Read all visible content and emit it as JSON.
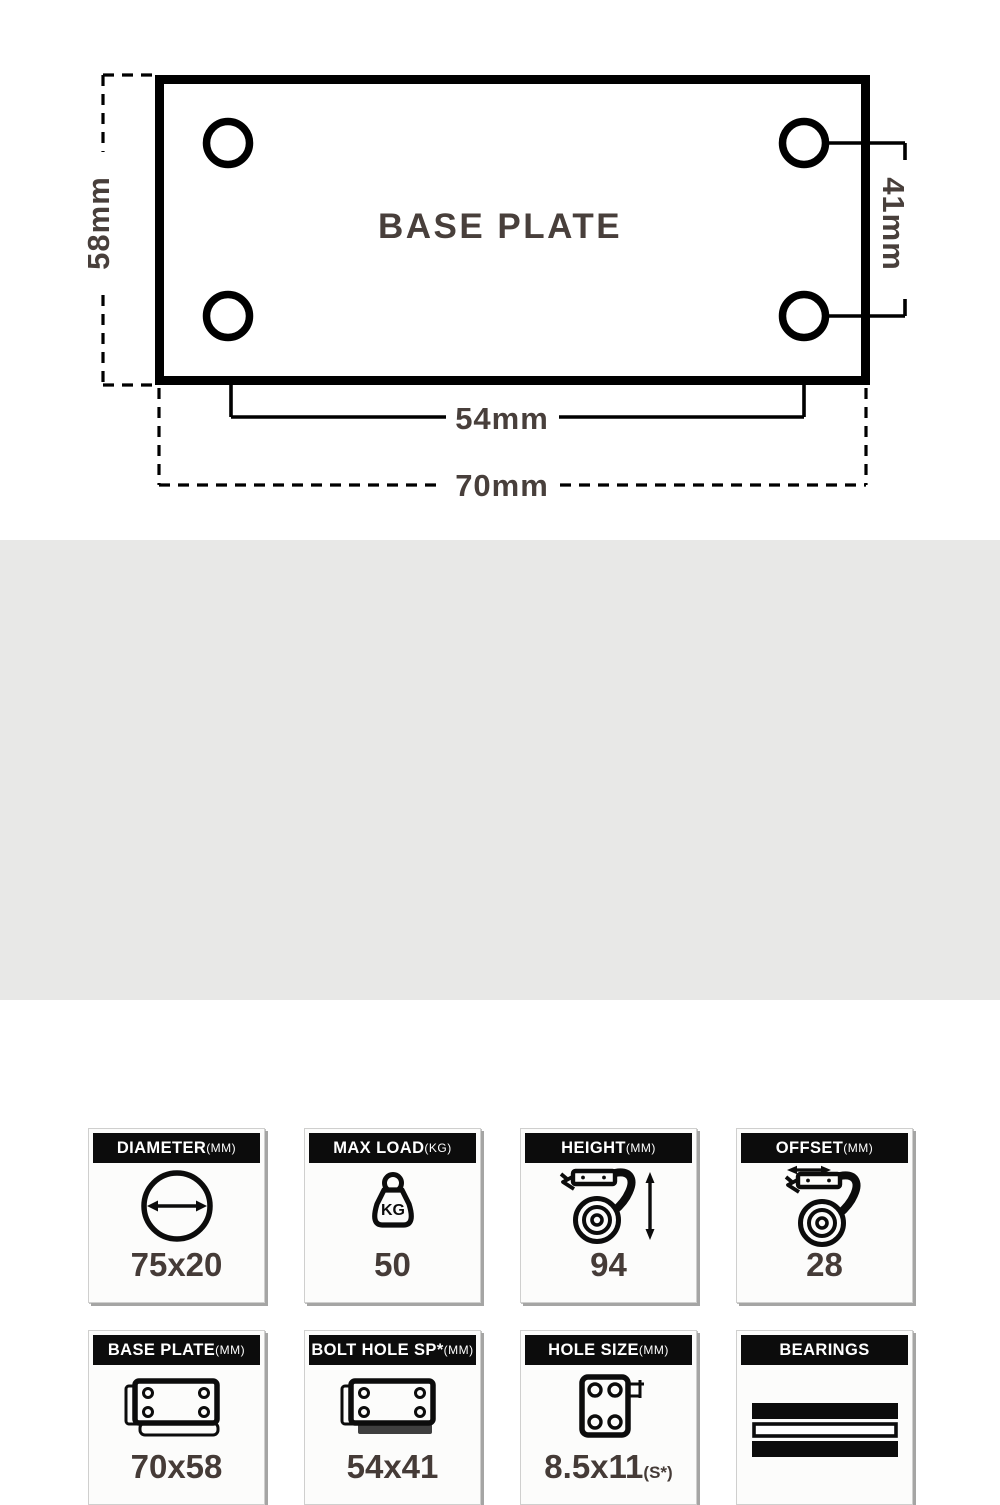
{
  "diagram": {
    "plate_label": "BASE PLATE",
    "dim_plate_height": "58mm",
    "dim_hole_spacing_v": "41mm",
    "dim_hole_spacing_h": "54mm",
    "dim_plate_width": "70mm"
  },
  "specs": {
    "kg_icon_text": "KG",
    "cards": [
      {
        "label": "DIAMETER",
        "unit": "(MM)",
        "icon": "diameter-icon",
        "value": "75x20",
        "suffix": ""
      },
      {
        "label": "MAX LOAD",
        "unit": "(KG)",
        "icon": "max-load-icon",
        "value": "50",
        "suffix": ""
      },
      {
        "label": "HEIGHT",
        "unit": "(MM)",
        "icon": "height-icon",
        "value": "94",
        "suffix": ""
      },
      {
        "label": "OFFSET",
        "unit": "(MM)",
        "icon": "offset-icon",
        "value": "28",
        "suffix": ""
      },
      {
        "label": "BASE PLATE",
        "unit": "(MM)",
        "icon": "base-plate-icon",
        "value": "70x58",
        "suffix": ""
      },
      {
        "label": "BOLT HOLE SP*",
        "unit": "(MM)",
        "icon": "bolt-hole-spacing-icon",
        "value": "54x41",
        "suffix": ""
      },
      {
        "label": "HOLE SIZE",
        "unit": "(MM)",
        "icon": "hole-size-icon",
        "value": "8.5x11",
        "suffix": "(S*)"
      },
      {
        "label": "BEARINGS",
        "unit": "",
        "icon": "bearings-icon",
        "value": "",
        "suffix": ""
      }
    ]
  },
  "colors": {
    "background_top": "#ffffff",
    "background_bottom": "#e8e8e7",
    "line_black": "#000000",
    "header_black": "#0c0c0c",
    "text_brown": "#483f3b"
  }
}
